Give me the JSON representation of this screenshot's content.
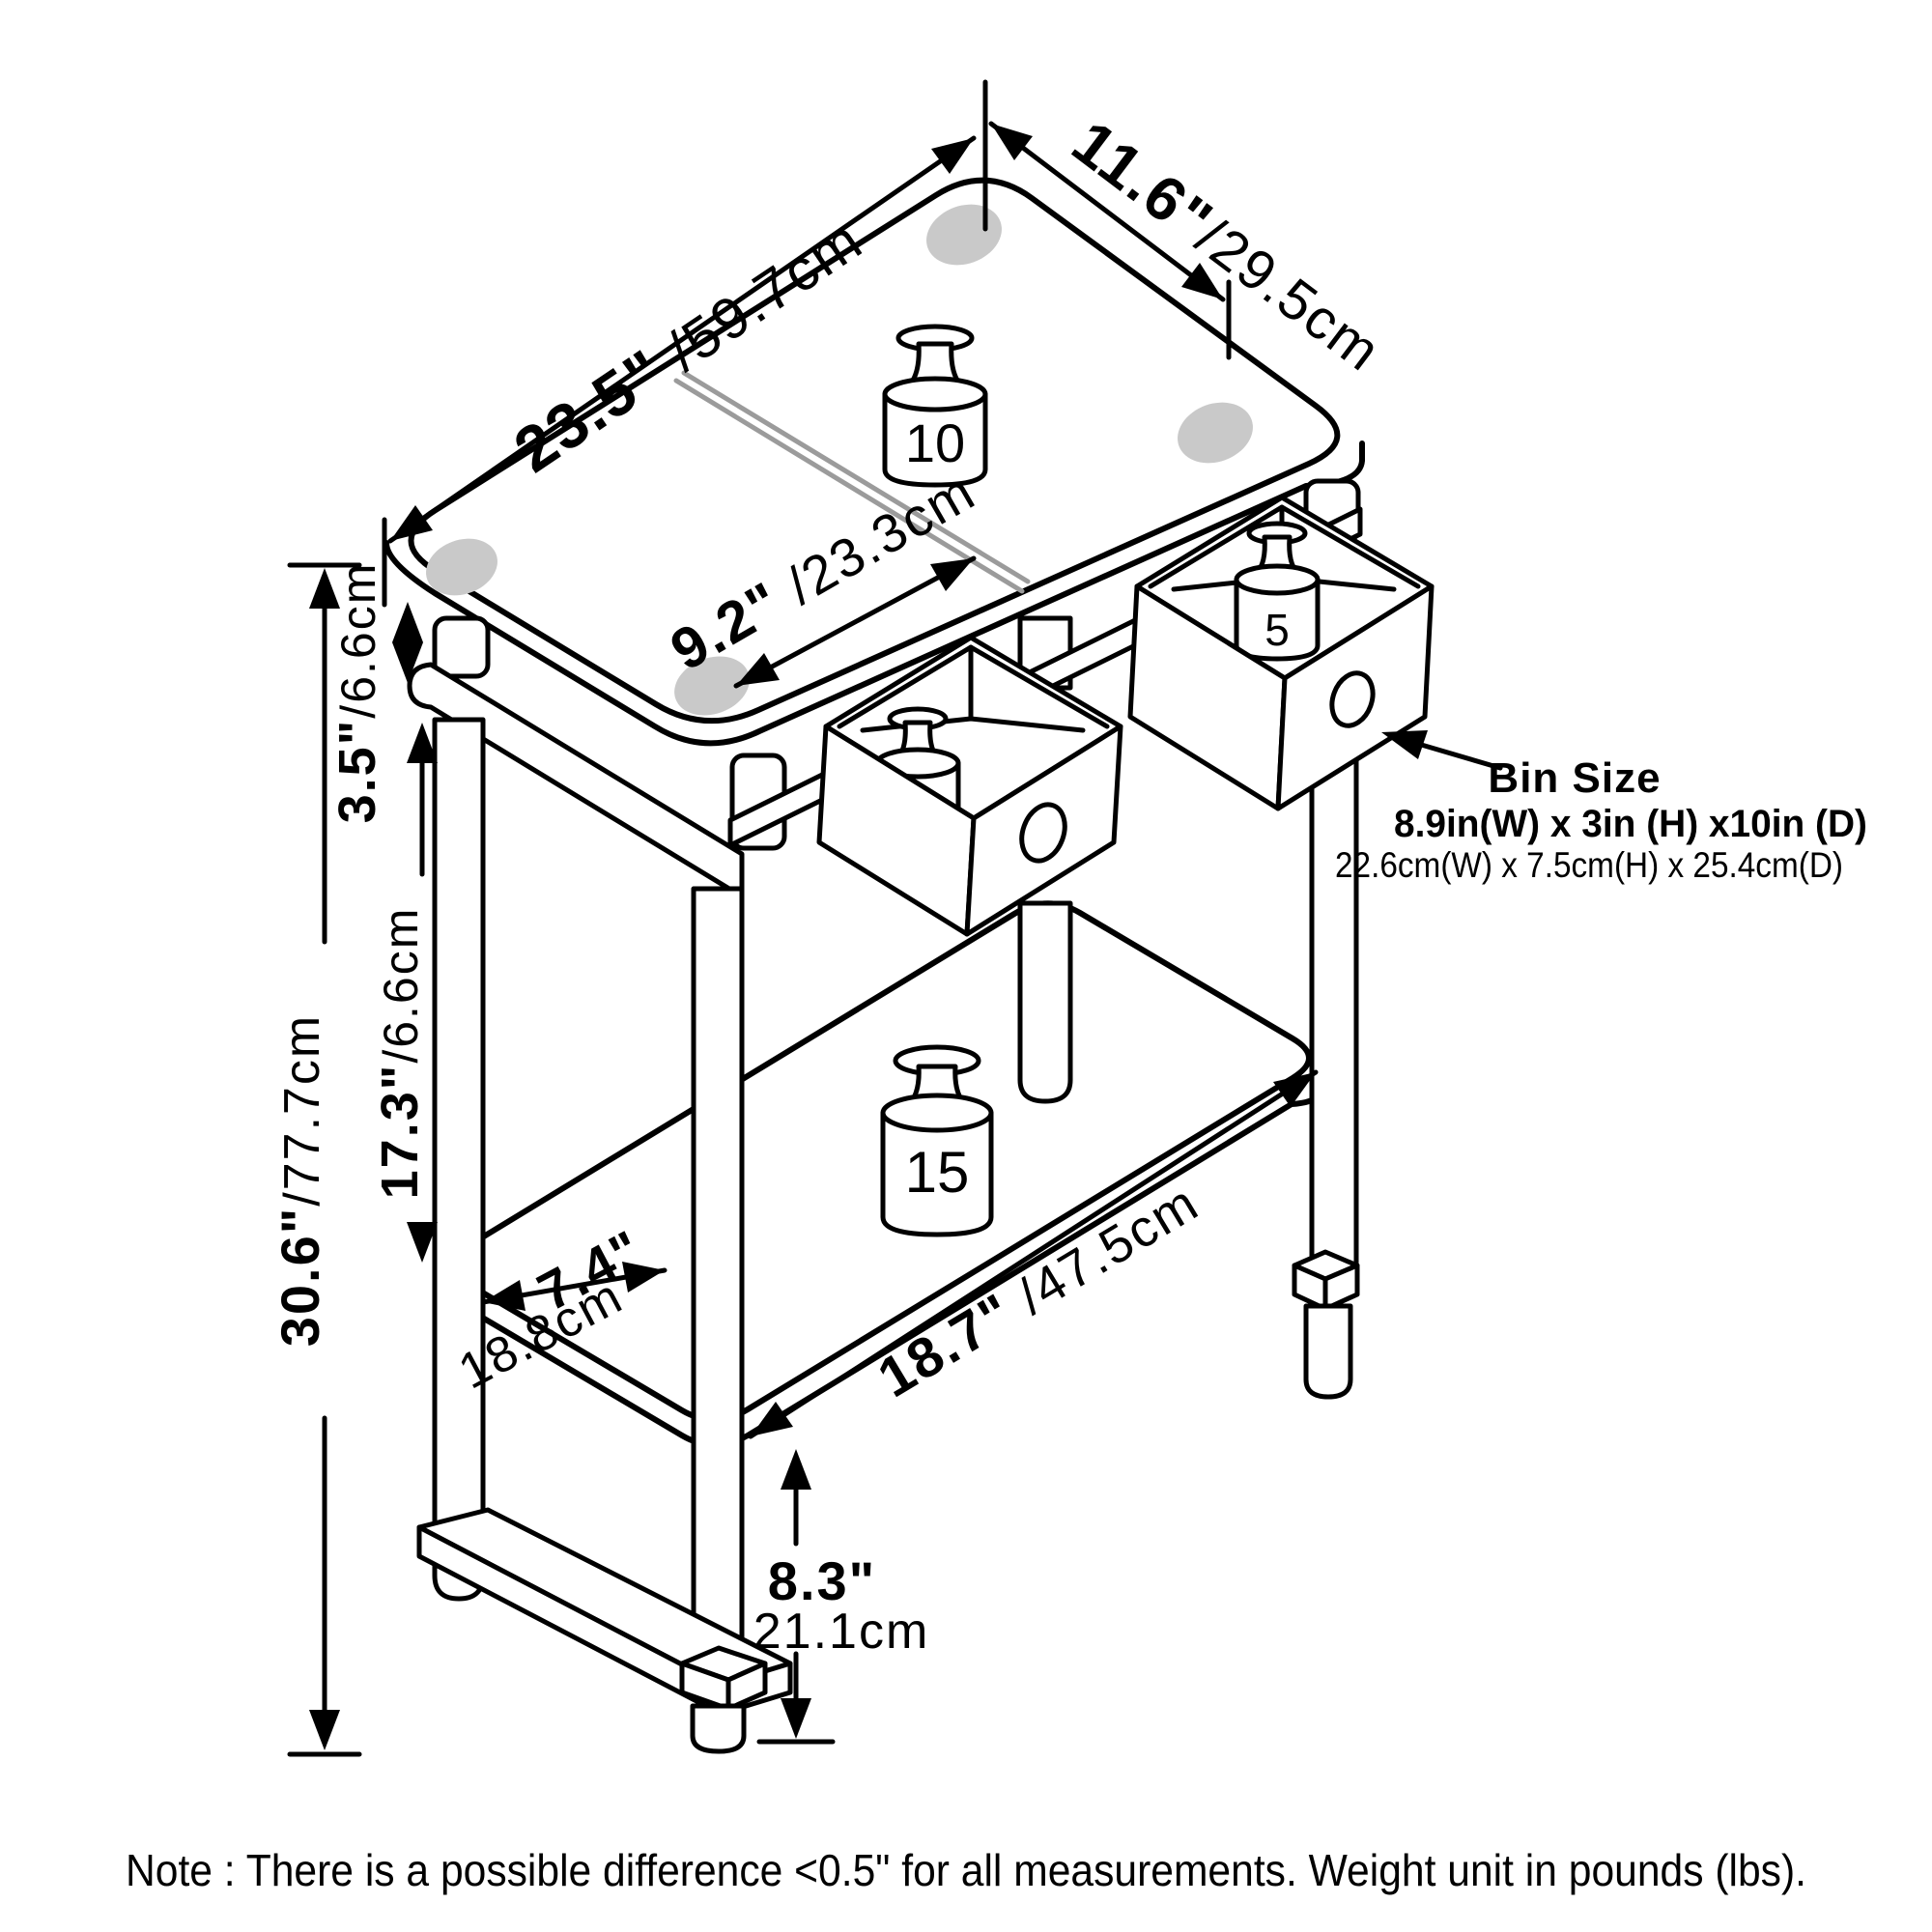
{
  "diagram": {
    "dims": {
      "top_width": {
        "in": "23.5\"",
        "cm": " /59.7cm"
      },
      "top_depth": {
        "in": "11.6\"",
        "cm": "/29.5cm"
      },
      "top_split": {
        "in": "9.2\"",
        "cm": " /23.3cm"
      },
      "gap": {
        "in": "3.5\"",
        "cm": "/6.6cm"
      },
      "mid": {
        "in": "17.3\"",
        "cm": "/6.6cm"
      },
      "height": {
        "in": "30.6\"",
        "cm": "/77.7cm"
      },
      "shelf_depth": {
        "in": "7.4\"",
        "cm": "18.8cm"
      },
      "shelf_width": {
        "in": "18.7\"",
        "cm": " /47.5cm"
      },
      "clearance": {
        "in": "8.3\"",
        "cm": "21.1cm"
      }
    },
    "weights": {
      "top": "10",
      "left_bin": "5",
      "right_bin": "5",
      "shelf": "15"
    },
    "bin_size": {
      "heading": "Bin Size",
      "inches": "8.9in(W) x 3in (H) x10in (D)",
      "metric": "22.6cm(W) x 7.5cm(H) x 25.4cm(D)"
    },
    "note": "Note : There is a possible difference <0.5\" for all measurements. Weight unit in pounds (lbs)."
  }
}
